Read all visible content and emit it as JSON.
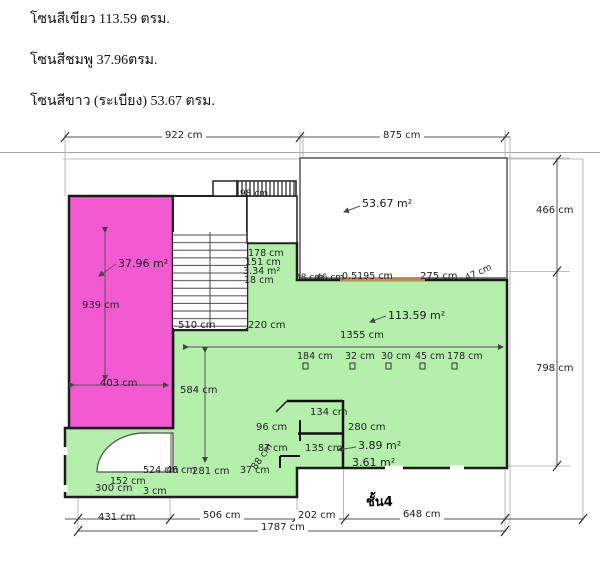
{
  "legend": {
    "green_line": "โซนสีเขียว 113.59 ตรม.",
    "pink_line": "โซนสีชมพู 37.96ตรม.",
    "white_line": "โซนสีขาว (ระเบียง) 53.67 ตรม."
  },
  "colors": {
    "pink_zone": "#f25ad2",
    "green_zone": "#b4f0ac",
    "wall": "#1c1c1c",
    "dim_line": "#555555",
    "window": "#b9895a"
  },
  "plan": {
    "floor_label": "ชั้น4",
    "areas": {
      "white_balcony": "53.67 m²",
      "pink": "37.96 m²",
      "green": "113.59 m²",
      "room_a": "3.89 m²",
      "room_b": "3.61 m²",
      "stair_side": "3.34 m²"
    },
    "dims": {
      "w922": "922 cm",
      "w875": "875 cm",
      "h466": "466 cm",
      "h798": "798 cm",
      "w98": "98 cm",
      "v939": "939 cm",
      "w403": "403 cm",
      "w178a": "178 cm",
      "w151": "151 cm",
      "w18": "18 cm",
      "w38": "38 cm",
      "w46a": "46 cm",
      "w05195": "0.5195 cm",
      "w275": "275 cm",
      "w47": "47 cm",
      "w510": "510 cm",
      "w220": "220 cm",
      "w1355": "1355 cm",
      "w184": "184 cm",
      "w32": "32 cm",
      "w30": "30 cm",
      "w45": "45 cm",
      "w178b": "178 cm",
      "v584": "584 cm",
      "w134": "134 cm",
      "w96": "96 cm",
      "w280": "280 cm",
      "w135": "135 cm",
      "w87": "87 cm",
      "w88": "88 cm",
      "w524": "524 cm",
      "w46b": "46 cm",
      "w281": "281 cm",
      "w37": "37 cm",
      "w300": "300 cm",
      "w152": "152 cm",
      "w3": "3 cm",
      "w431": "431 cm",
      "w506": "506 cm",
      "w202": "202 cm",
      "w648": "648 cm",
      "w1787": "1787 cm"
    }
  }
}
